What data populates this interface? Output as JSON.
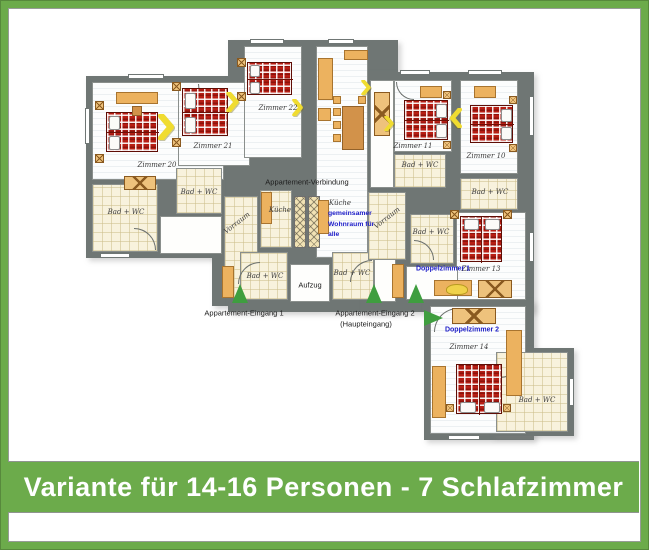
{
  "banner": {
    "title": "Variante für 14-16 Personen - 7 Schlafzimmer",
    "bg_color": "#6cab4b",
    "text_color": "#ffffff"
  },
  "plan": {
    "bedrooms": [
      {
        "name": "Zimmer 20"
      },
      {
        "name": "Zimmer 21"
      },
      {
        "name": "Zimmer 22"
      },
      {
        "name": "Zimmer 11"
      },
      {
        "name": "Zimmer 10"
      },
      {
        "name": "Zimmer 13"
      },
      {
        "name": "Zimmer 14"
      }
    ],
    "room_types": {
      "bath": "Bad + WC",
      "kitchen": "Küche",
      "hall": "Vorraum"
    },
    "labels": {
      "connection": "Appartement-Verbindung",
      "shared_lines": [
        "gemeinsamer",
        "Wohnraum für",
        "alle"
      ],
      "double1": "Doppelzimmer 1",
      "double2": "Doppelzimmer 2",
      "lift": "Aufzug",
      "entrance1": "Appartement-Eingang 1",
      "entrance2": "Appartement-Eingang 2",
      "entrance2_sub": "(Haupteingang)"
    },
    "colors": {
      "wall": "#6f7674",
      "bed_red": "#b71e14",
      "furniture_orange": "#ecb25f",
      "entrance_arrow_green": "#3f9e3f",
      "connector_yellow": "#f0dc30",
      "accent_blue": "#1d1dc8"
    }
  }
}
